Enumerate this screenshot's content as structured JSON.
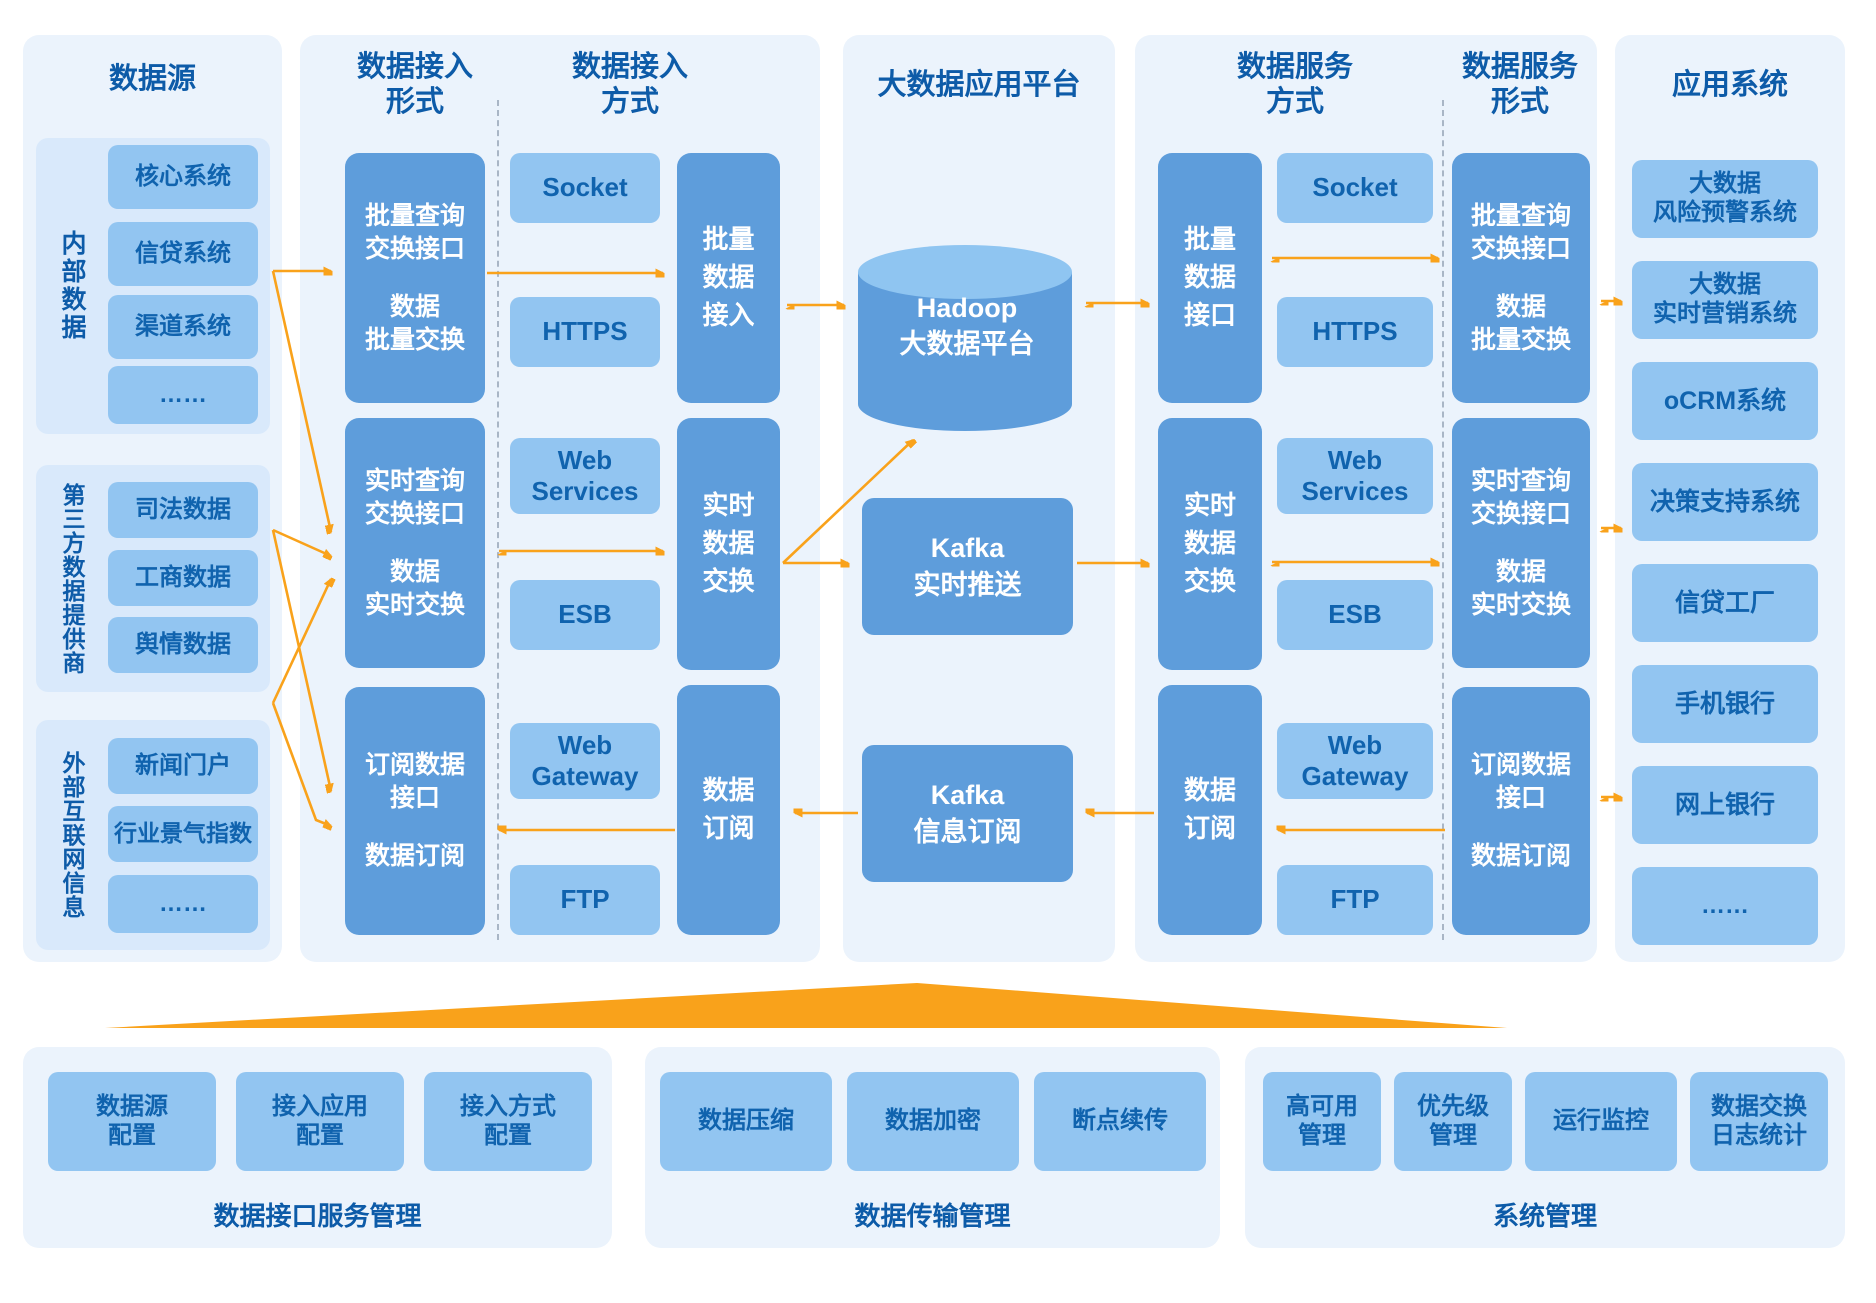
{
  "colors": {
    "accent_orange": "#F9A21B",
    "dark_box_blue": "#5E9DDB",
    "light_box_blue": "#92C5F1",
    "panel_bg": "#EBF3FC",
    "group_bg": "#D9E9FB",
    "heading_blue": "#0D5BA8"
  },
  "panels": {
    "source": {
      "title": "数据源",
      "groups": [
        {
          "label": "内部数据",
          "items": [
            "核心系统",
            "信贷系统",
            "渠道系统",
            "……"
          ]
        },
        {
          "label": "第三方数据提供商",
          "items": [
            "司法数据",
            "工商数据",
            "舆情数据"
          ]
        },
        {
          "label": "外部互联网信息",
          "items": [
            "新闻门户",
            "行业景气指数",
            "……"
          ]
        }
      ]
    },
    "ingest": {
      "form_title": "数据接入\n形式",
      "mode_title": "数据接入\n方式",
      "form_boxes": [
        {
          "line1": "批量查询\n交换接口",
          "line2": "数据\n批量交换"
        },
        {
          "line1": "实时查询\n交换接口",
          "line2": "数据\n实时交换"
        },
        {
          "line1": "订阅数据\n接口",
          "line2": "数据订阅"
        }
      ],
      "mode_items": [
        "Socket",
        "HTTPS",
        "Web\nServices",
        "ESB",
        "Web\nGateway",
        "FTP"
      ],
      "bars": [
        "批量\n数据\n接入",
        "实时\n数据\n交换",
        "数据\n订阅"
      ]
    },
    "platform": {
      "title": "大数据应用平台",
      "hadoop": "Hadoop\n大数据平台",
      "kafka_push": "Kafka\n实时推送",
      "kafka_sub": "Kafka\n信息订阅"
    },
    "service": {
      "mode_title": "数据服务\n方式",
      "form_title": "数据服务\n形式",
      "bars": [
        "批量\n数据\n接口",
        "实时\n数据\n交换",
        "数据\n订阅"
      ],
      "mode_items": [
        "Socket",
        "HTTPS",
        "Web\nServices",
        "ESB",
        "Web\nGateway",
        "FTP"
      ],
      "form_boxes": [
        {
          "line1": "批量查询\n交换接口",
          "line2": "数据\n批量交换"
        },
        {
          "line1": "实时查询\n交换接口",
          "line2": "数据\n实时交换"
        },
        {
          "line1": "订阅数据\n接口",
          "line2": "数据订阅"
        }
      ]
    },
    "apps": {
      "title": "应用系统",
      "items": [
        "大数据\n风险预警系统",
        "大数据\n实时营销系统",
        "oCRM系统",
        "决策支持系统",
        "信贷工厂",
        "手机银行",
        "网上银行",
        "……"
      ]
    }
  },
  "bottom": [
    {
      "caption": "数据接口服务管理",
      "items": [
        "数据源\n配置",
        "接入应用\n配置",
        "接入方式\n配置"
      ]
    },
    {
      "caption": "数据传输管理",
      "items": [
        "数据压缩",
        "数据加密",
        "断点续传"
      ]
    },
    {
      "caption": "系统管理",
      "items": [
        "高可用\n管理",
        "优先级\n管理",
        "运行监控",
        "数据交换\n日志统计"
      ]
    }
  ]
}
